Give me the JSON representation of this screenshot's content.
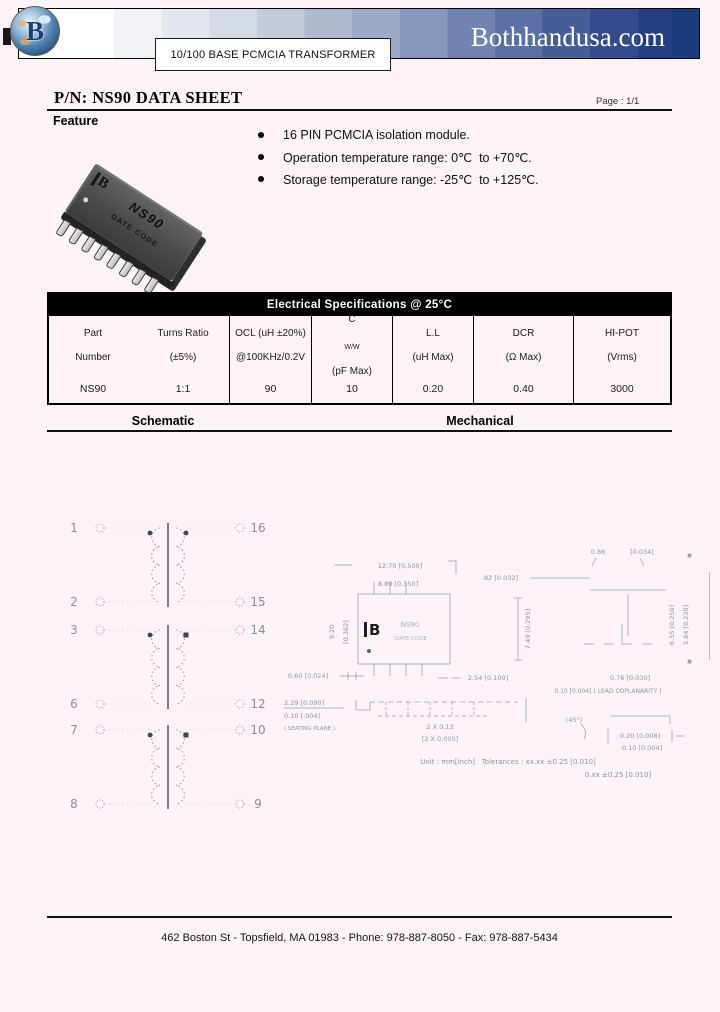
{
  "colors": {
    "banner_navy": "#1c3a7e",
    "table_header_bg": "#000000",
    "page_bg": "#fcf3f9"
  },
  "header": {
    "site_name": "Bothhandusa.com",
    "logo_letter": "B",
    "product_banner": "10/100 BASE PCMCIA TRANSFORMER"
  },
  "title_bar": {
    "title": "P/N: NS90 DATA SHEET",
    "page": "Page : 1/1"
  },
  "feature": {
    "heading": "Feature",
    "bullets": [
      "16 PIN PCMCIA isolation module.",
      "Operation temperature range: 0℃  to +70℃.",
      "Storage temperature range: -25℃  to +125℃."
    ],
    "chip_logo": "B",
    "chip_label": "NS90",
    "chip_sublabel": "DATE CODE"
  },
  "spec_table": {
    "title": "Electrical Specifications @ 25°C",
    "columns": [
      {
        "line1": "Part",
        "line2": "Number"
      },
      {
        "line1": "Turns Ratio",
        "line2": "(±5%)"
      },
      {
        "line1": "OCL (uH ±20%)",
        "line2": "@100KHz/0.2V"
      },
      {
        "line1_main": "C",
        "line1_sub": "W/W",
        "line2": "(pF Max)"
      },
      {
        "line1": "L.L",
        "line2": "(uH Max)"
      },
      {
        "line1": "DCR",
        "line2": "(Ω  Max)"
      },
      {
        "line1": "HI-POT",
        "line2": "(Vrms)"
      }
    ],
    "row": [
      "NS90",
      "1:1",
      "90",
      "10",
      "0.20",
      "0.40",
      "3000"
    ]
  },
  "sections": {
    "schematic_title": "Schematic",
    "mechanical_title": "Mechanical"
  },
  "schematic": {
    "transformers": [
      {
        "left_top": "1",
        "left_bottom": "2",
        "right_top": "16",
        "right_bottom": "15"
      },
      {
        "left_top": "3",
        "left_bottom": "6",
        "right_top": "14",
        "right_bottom": "12"
      },
      {
        "left_top": "7",
        "left_bottom": "8",
        "right_top": "10",
        "right_bottom": "9"
      }
    ]
  },
  "mechanical": {
    "top_view": {
      "part": "NS90",
      "date_code": "DATE CODE",
      "logo_letter": "B",
      "dim_width": "12.70 [0.500]",
      "dim_inner": "8.89 [0.350]",
      "dim_lead": ".82 [0.032]",
      "dim_side_mm": "9.20",
      "dim_side_in": "[0.362]",
      "dim_height": "7.49 [0.295]",
      "dim_pin1": "0.60 [0.024]",
      "dim_pitch": "2.54 [0.100]"
    },
    "end_view": {
      "dim_top_mm": "0.86",
      "dim_top_in": "[0.034]",
      "dim_bottom": "0.76 [0.030]",
      "note": "0.10 [0.004] ( LEAD COPLANARITY )",
      "dim_right_a": "6.35 [0.250]",
      "dim_right_b": "5.84 [0.230]"
    },
    "side_view": {
      "dim_a": "2.29 [0.090]",
      "dim_b": "0.10 [.004]",
      "dim_c": "( SEATING PLANE )",
      "dim_d": "2 X 0.13",
      "dim_e": "[2 X 0.005]"
    },
    "detail_view": {
      "angle": "(45°)",
      "dim_a": "0.20 [0.008]",
      "dim_b": "0.10 [0.004]"
    },
    "notes": {
      "line1": "Unit : mm[inch]   Tolerances : xx.xx ±0.25 [0.010]",
      "line2": "0.xx ±0.25 [0.010]"
    }
  },
  "footer": {
    "address": "462 Boston St - Topsfield, MA 01983 - Phone: 978-887-8050 - Fax: 978-887-5434"
  }
}
